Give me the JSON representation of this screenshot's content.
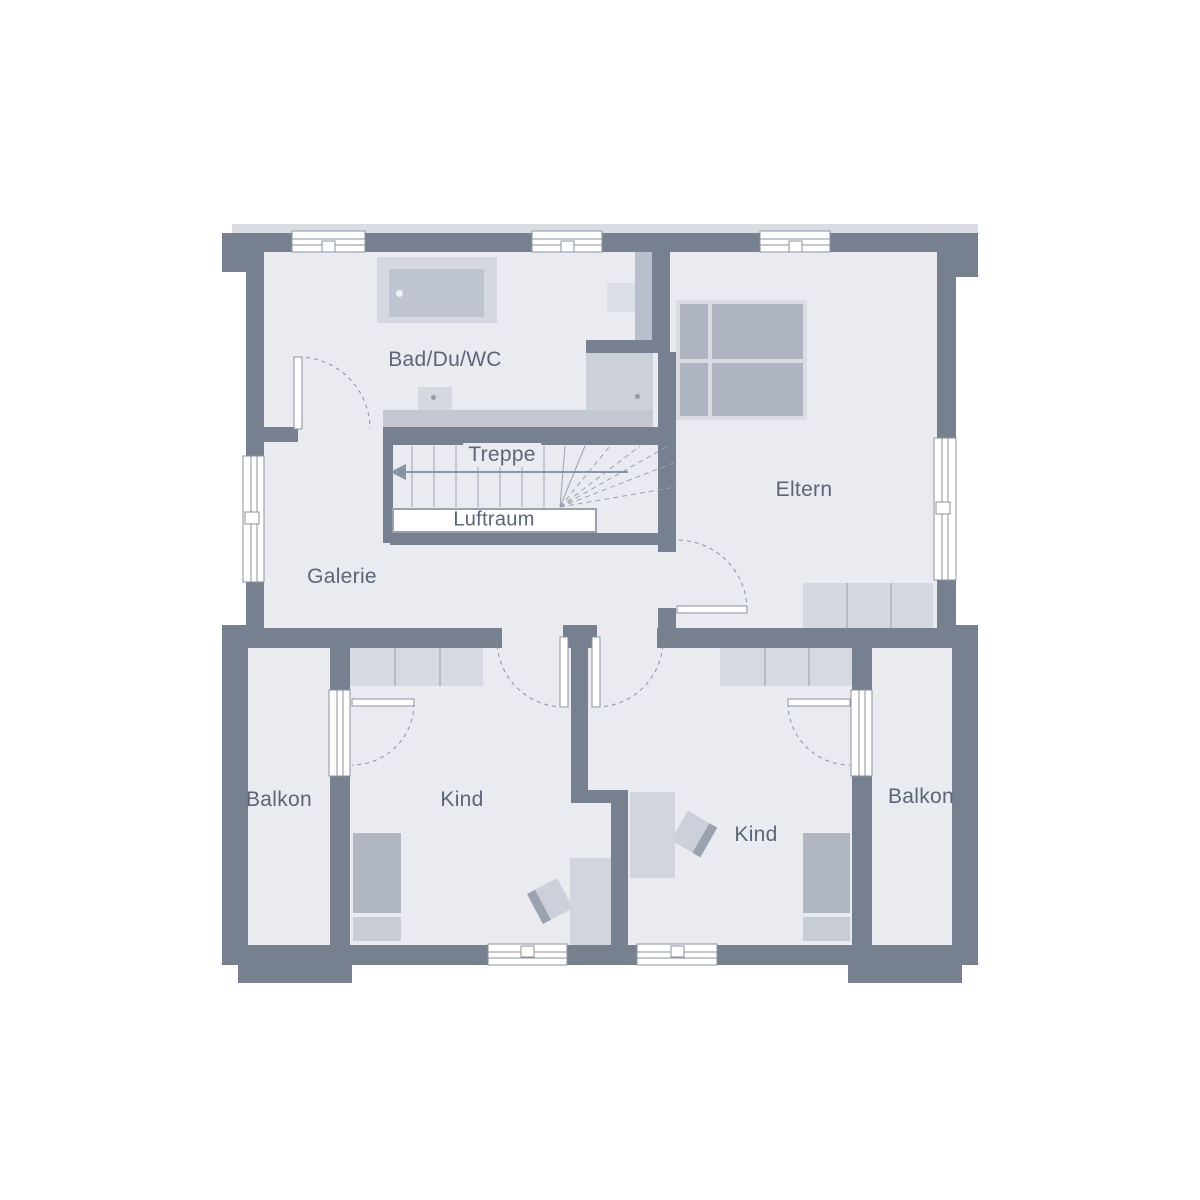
{
  "rooms": {
    "bath": {
      "label": "Bad/Du/WC"
    },
    "stairs": {
      "label": "Treppe"
    },
    "void": {
      "label": "Luftraum"
    },
    "gallery": {
      "label": "Galerie"
    },
    "parents": {
      "label": "Eltern"
    },
    "child_left": {
      "label": "Kind"
    },
    "child_right": {
      "label": "Kind"
    },
    "balcony_left": {
      "label": "Balkon"
    },
    "balcony_right": {
      "label": "Balkon"
    }
  },
  "colors": {
    "background": "#ffffff",
    "wall": "#76808f",
    "floor": "#e9ebf1",
    "furniture_light": "#d6d9e1",
    "furniture_medium": "#b9bfca",
    "bed": "#aeb4c0",
    "line": "#8a93a1",
    "label_text": "#5b6577"
  }
}
